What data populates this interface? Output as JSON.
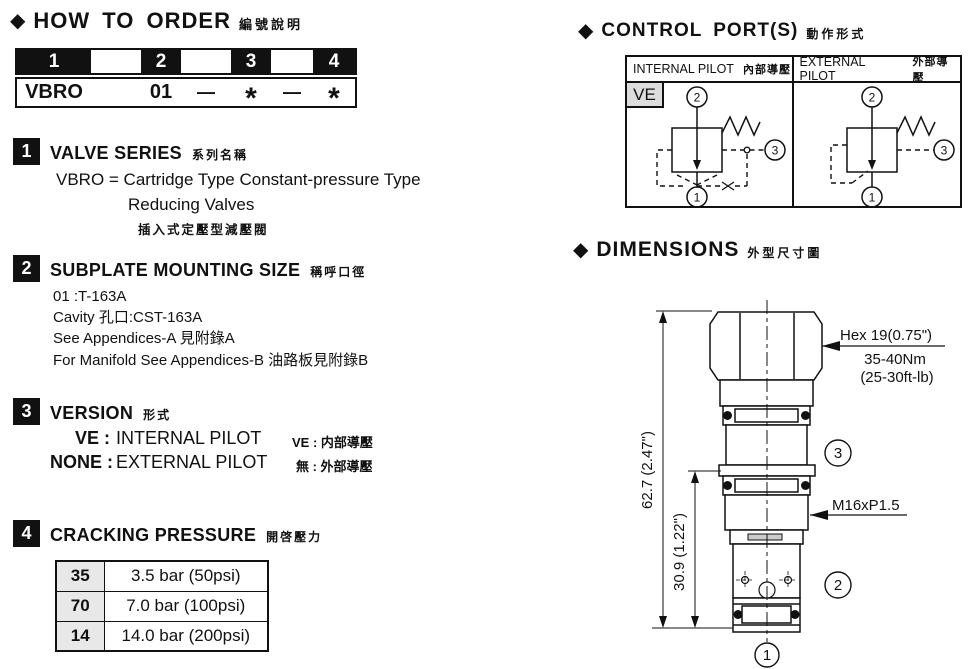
{
  "order": {
    "title": "HOW TO ORDER",
    "title_zh": "編號說明",
    "header_cells": [
      "1",
      "",
      "2",
      "",
      "3",
      "",
      "4"
    ],
    "code_cells": {
      "c0": "VBRO",
      "c2": "01",
      "c3": "—",
      "c4": "*",
      "c5": "—",
      "c6": "*"
    }
  },
  "sections": {
    "s1": {
      "num": "1",
      "title": "VALVE SERIES",
      "title_zh": "系列名稱",
      "line1": "VBRO = Cartridge Type  Constant-pressure Type",
      "line2": "Reducing Valves",
      "line3": "插入式定壓型減壓閥"
    },
    "s2": {
      "num": "2",
      "title": "SUBPLATE MOUNTING SIZE",
      "title_zh": "稱呼口徑",
      "line1": "01 :T-163A",
      "line2": "Cavity 孔口:CST-163A",
      "line3": "See Appendices-A 見附錄A",
      "line4": "For Manifold See Appendices-B 油路板見附錄B"
    },
    "s3": {
      "num": "3",
      "title": "VERSION",
      "title_zh": "形式",
      "rows": [
        {
          "label": "VE :",
          "value": "INTERNAL PILOT",
          "zh": "VE : 内部導壓"
        },
        {
          "label": "NONE :",
          "value": "EXTERNAL PILOT",
          "zh": "無 : 外部導壓"
        }
      ]
    },
    "s4": {
      "num": "4",
      "title": "CRACKING PRESSURE",
      "title_zh": "開啓壓力",
      "rows": [
        {
          "code": "35",
          "value": "3.5 bar (50psi)"
        },
        {
          "code": "70",
          "value": "7.0 bar (100psi)"
        },
        {
          "code": "14",
          "value": "14.0 bar (200psi)"
        }
      ]
    }
  },
  "control": {
    "title": "CONTROL PORT(S)",
    "title_zh": "動作形式",
    "col1": {
      "title": "INTERNAL PILOT",
      "title_zh": "內部導壓",
      "badge": "VE"
    },
    "col2": {
      "title": "EXTERNAL PILOT",
      "title_zh": "外部導壓"
    },
    "ports": {
      "p1": "1",
      "p2": "2",
      "p3": "3"
    }
  },
  "dimensions": {
    "title": "DIMENSIONS",
    "title_zh": "外型尺寸圖",
    "height_total": "62.7 (2.47\")",
    "height_lower": "30.9 (1.22\")",
    "hex": "Hex 19(0.75\")",
    "torque": "35-40Nm",
    "torque_lb": "(25-30ft-lb)",
    "thread": "M16xP1.5",
    "ports": {
      "p1": "1",
      "p2": "2",
      "p3": "3"
    }
  }
}
